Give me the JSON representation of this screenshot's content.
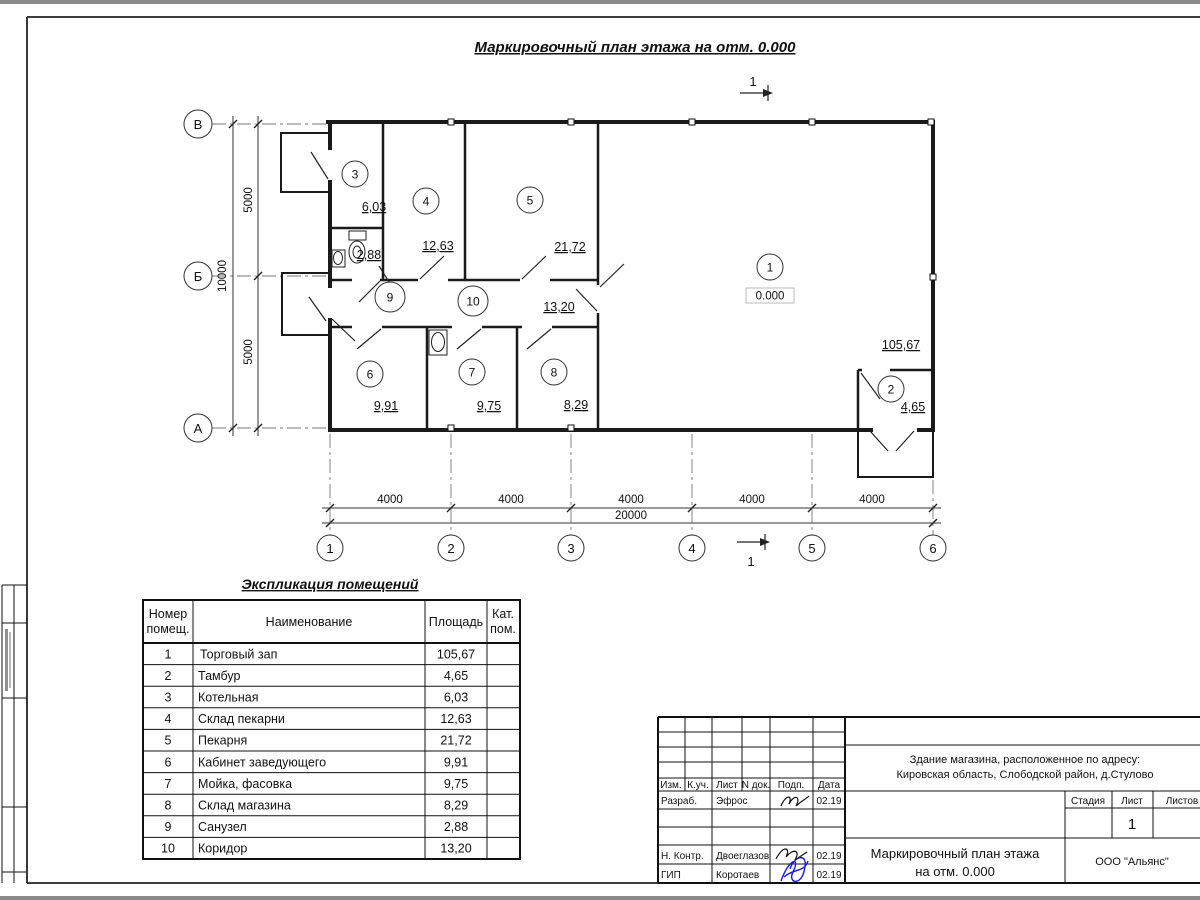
{
  "page": {
    "title": "Маркировочный план этажа на отм. 0.000"
  },
  "plan": {
    "section_label": "1",
    "elevation": "0.000",
    "axes_rows": [
      "В",
      "Б",
      "А"
    ],
    "axes_cols": [
      "1",
      "2",
      "3",
      "4",
      "5",
      "6"
    ],
    "dims": {
      "h_segments": [
        "4000",
        "4000",
        "4000",
        "4000",
        "4000"
      ],
      "h_total": "20000",
      "v_inner": [
        "5000",
        "5000"
      ],
      "v_total": "10000"
    },
    "rooms": [
      {
        "num": "1",
        "area": "105,67"
      },
      {
        "num": "2",
        "area": "4,65"
      },
      {
        "num": "3",
        "area": "6,03"
      },
      {
        "num": "4",
        "area": "12,63"
      },
      {
        "num": "5",
        "area": "21,72"
      },
      {
        "num": "6",
        "area": "9,91"
      },
      {
        "num": "7",
        "area": "9,75"
      },
      {
        "num": "8",
        "area": "8,29"
      },
      {
        "num": "9",
        "area": "2,88"
      },
      {
        "num": "10",
        "area": "13,20"
      }
    ]
  },
  "schedule": {
    "title": "Экспликация помещений",
    "col_num": [
      "Номер",
      "помещ."
    ],
    "col_name": "Наименование",
    "col_area": "Площадь",
    "col_cat": [
      "Кат.",
      "пом."
    ],
    "rows": [
      {
        "num": "1",
        "name": "Торговый зап",
        "area": "105,67"
      },
      {
        "num": "2",
        "name": "Тамбур",
        "area": "4,65"
      },
      {
        "num": "3",
        "name": "Котельная",
        "area": "6,03"
      },
      {
        "num": "4",
        "name": "Склад пекарни",
        "area": "12,63"
      },
      {
        "num": "5",
        "name": "Пекарня",
        "area": "21,72"
      },
      {
        "num": "6",
        "name": "Кабинет заведующего",
        "area": "9,91"
      },
      {
        "num": "7",
        "name": "Мойка, фасовка",
        "area": "9,75"
      },
      {
        "num": "8",
        "name": "Склад магазина",
        "area": "8,29"
      },
      {
        "num": "9",
        "name": "Санузел",
        "area": "2,88"
      },
      {
        "num": "10",
        "name": "Коридор",
        "area": "13,20"
      }
    ]
  },
  "stamp": {
    "cols": [
      "Изм.",
      "К.уч.",
      "Лист",
      "N док.",
      "Подп.",
      "Дата"
    ],
    "sign_rows": [
      {
        "label": "Разраб.",
        "name": "Эфрос",
        "date": "02.19"
      },
      {
        "label": "Н. Контр.",
        "name": "Двоеглазов",
        "date": "02.19"
      },
      {
        "label": "ГИП",
        "name": "Коротаев",
        "date": "02.19"
      }
    ],
    "project": [
      "Здание магазина, расположенное по адресу:",
      "Кировская область, Слободской район, д.Стулово"
    ],
    "stage_label": "Стадия",
    "sheet_label": "Лист",
    "sheets_label": "Листов",
    "sheet_num": "1",
    "title_lines": [
      "Маркировочный план этажа",
      "на отм. 0.000"
    ],
    "org": "ООО \"Альянс\""
  }
}
